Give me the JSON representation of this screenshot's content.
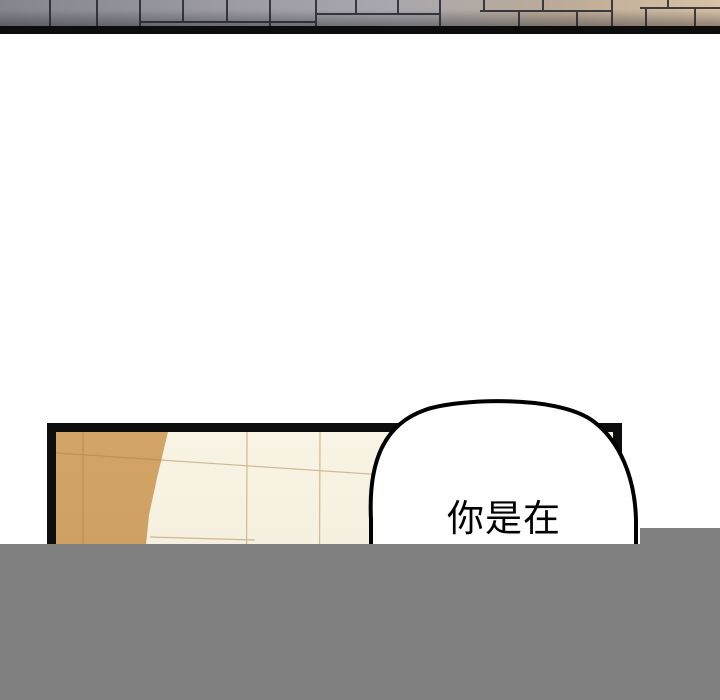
{
  "page": {
    "width": 720,
    "height": 700,
    "background": "#ffffff"
  },
  "colors": {
    "panel_border": "#0d0d0d",
    "pavement_left": "#84858d",
    "pavement_mid": "#a9a8ae",
    "pavement_right": "#d8c2a5",
    "pavement_joint": "#23252e",
    "tile_cream": "#f6f1e1",
    "tile_tan": "#cfa062",
    "tile_seam": "#a97f3f",
    "bubble_fill": "#ffffff",
    "bubble_stroke": "#000000",
    "text_color": "#000000",
    "overlay_gray": "#808080"
  },
  "speech_bubble": {
    "text": "你是在"
  }
}
